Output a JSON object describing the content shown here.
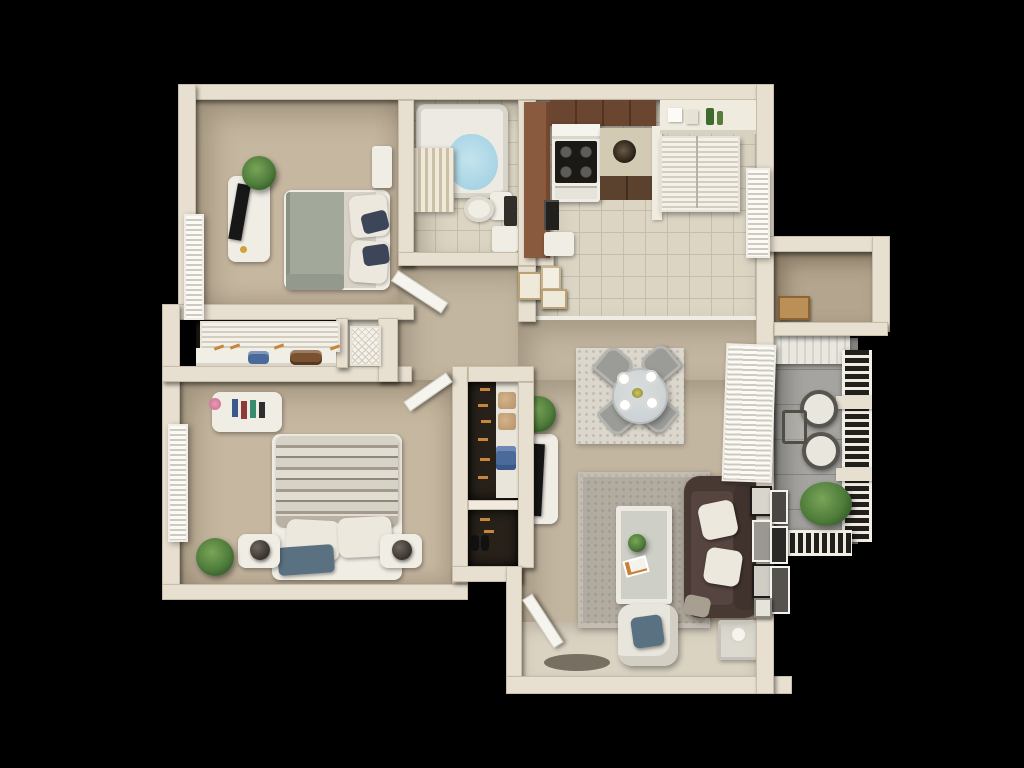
{
  "scene": {
    "type": "3d-floor-plan-render",
    "description": "Top-down 3D rendering of a two-bedroom, one-bath apartment floor plan on a black background",
    "background": "#000000",
    "visible_text": []
  },
  "palette": {
    "wall": "#e7dfd0",
    "wallLight": "#f1ebdf",
    "wallEdge": "#c7bda8",
    "carpetBed": "#c6b7a0",
    "carpetMain": "#c3b6a1",
    "entryFloor": "#dad3c2",
    "tile": "#dcd5c4",
    "grout": "#c6beac",
    "balcony": "#a5a4a0",
    "storageFloor": "#b4a68e",
    "closetDark": "#27211a",
    "counter": "#8a5a3e",
    "cabinet": "#6a4631",
    "cabinetDark": "#5a422e",
    "white": "#f0ede5",
    "stoveBlack": "#1b1916",
    "water": "#a8d4e4",
    "couch": "#483933",
    "couchSeat": "#564440",
    "pillowWhite": "#ece8dd",
    "navy": "#3d4558",
    "duvetGreen": "#a2a89a",
    "sheet": "#d8d2c6",
    "blueThrow": "#5a7181",
    "rugLiving": "#b2ab9f",
    "rugDining": "#dbd7cc",
    "chairGray": "#9b9b97",
    "glass": "#ccd2d4",
    "boxTan": "#bb9057",
    "matDark": "#6b6458",
    "hangerOrange": "#c8863c",
    "bagBlue": "#4a6a9c",
    "bagBrown": "#7a5230"
  },
  "rooms": {
    "bedroom1": {
      "name": "Bedroom 1",
      "features": [
        "queen bed with sage duvet and navy pillows",
        "media console with TV",
        "potted plant",
        "nightstand",
        "window with blinds"
      ]
    },
    "bathroom": {
      "name": "Bathroom",
      "features": [
        "bathtub with shower curtain",
        "toilet",
        "vanity",
        "tile floor"
      ]
    },
    "kitchen": {
      "name": "Kitchen",
      "features": [
        "L-shaped brown counter",
        "range with hood",
        "upper cabinets",
        "sink cabinet",
        "tile floor"
      ]
    },
    "pantry_nook": {
      "name": "Pantry shelf nook",
      "features": [
        "open shelf with jars",
        "louvered utility closet doors",
        "window"
      ]
    },
    "hallway": {
      "name": "Hallway",
      "features": [
        "open door",
        "three wall frames"
      ]
    },
    "linen_closet": {
      "name": "Bedroom closet",
      "features": [
        "louvered sliding doors",
        "shelf with duffel bags and hangers",
        "lattice utility door"
      ]
    },
    "bedroom2": {
      "name": "Bedroom 2",
      "features": [
        "bed with patterned boho duvet",
        "two nightstands with round lamps",
        "dresser with books",
        "plant",
        "window with blinds"
      ]
    },
    "hall_closet": {
      "name": "Hall closet",
      "features": [
        "shelves with baskets",
        "folded blue shirt",
        "shoes",
        "wooden hangers"
      ]
    },
    "dining": {
      "name": "Dining area",
      "features": [
        "round glass table",
        "four gray chairs",
        "white plates",
        "distressed area rug",
        "patio door blinds"
      ]
    },
    "living": {
      "name": "Living room",
      "features": [
        "brown tufted chesterfield sofa",
        "gray rug",
        "glass coffee table",
        "white accent chair with blue pillow",
        "media console with TV",
        "gallery wall frames",
        "side table",
        "entry door with mat"
      ]
    },
    "balcony": {
      "name": "Balcony",
      "features": [
        "wood and metal railing",
        "two bistro chairs",
        "small table",
        "large plant",
        "plank ceiling edge"
      ]
    },
    "storage": {
      "name": "Outdoor storage closet",
      "features": [
        "cardboard box"
      ]
    }
  },
  "furniture": {
    "bed_bedroom1": {
      "label": "Bed with sage green duvet, white and navy pillows"
    },
    "tv_console_bedroom1": {
      "label": "White media console with flat screen TV"
    },
    "bathtub": {
      "label": "Bathtub with blue water and striped shower curtain"
    },
    "toilet": {
      "label": "Toilet"
    },
    "stove": {
      "label": "White range with black cooktop and hood"
    },
    "counter": {
      "label": "Brown L-shaped kitchen counter"
    },
    "dining_table": {
      "label": "Round glass dining table with four gray chairs"
    },
    "sofa": {
      "label": "Dark brown tufted chesterfield sofa with white pillows"
    },
    "coffee_table": {
      "label": "Glass coffee table with plant and magazine"
    },
    "accent_chair": {
      "label": "White accent chair with blue pillow"
    },
    "bed_bedroom2": {
      "label": "Bed with patterned boho duvet, white pillows and blue throw"
    },
    "balcony_set": {
      "label": "Two bistro chairs with small table and plant"
    },
    "entry_door": {
      "label": "Open entry door with welcome mat"
    }
  }
}
